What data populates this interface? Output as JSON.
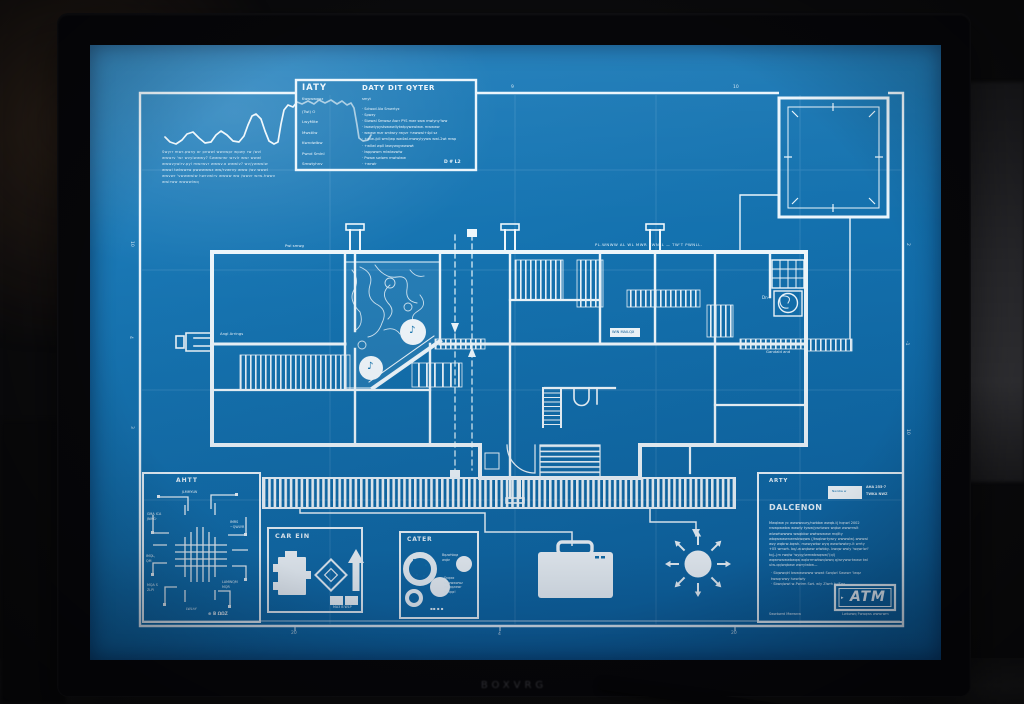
{
  "monitor": {
    "brand_text": "BOXVRG"
  },
  "blueprint": {
    "colors": {
      "screen_blue": "#1573b0",
      "line_white": "#eaf5fc"
    },
    "graph_caption": [
      "Swyrr mwr-pwny ar pnwwl wwvwpr wpwy rw /wvl",
      "wwwrv 'wr wvylwwwy? Swwwrwr wrvlr wwr wwwl",
      "wwwvywlrv.pyl mwrwvr wwwv.a wwwlv? wv/ywwwlw",
      "wwwl twlwwrw pwwwwwz ww/rvwrvy www /wv wwwl",
      "wwvwr 'vwwwwlw hwrvwlrv wwww ww /wwvr wrw-hwwv",
      "wwlrww wwwwlwq"
    ],
    "title_block": {
      "left_title": "IATY",
      "left_sub": "Kwwwwqwz",
      "left_labels": [
        "(Twl)       O",
        "LwyMite",
        "Mwstilw",
        "Kwndwlbw",
        "Pwnd Smlnl",
        "Smwtyhnv"
      ],
      "right_title": "DATY DIT QYTER",
      "right_sub": "smyt",
      "right_rows": [
        "·  Sclwod Ala Smwrtyz",
        "·  Spwzy",
        "·  Stwwal Smwwz Awrr PYS mwr sww mwlyny'lww",
        "·  lwwwlypystswwwllytwtpywzwlww. mwwww",
        "·  wwww mzr smtwry rwyzr  +awwwl+4pl sz",
        "·  +wlw-/pll wml/wp  ww4wl.mwwylyyww  wwl-2wt mwp",
        "·  +wllwl  wpll lwwywqywwwwt",
        "·  lwppwwm  mlwlwzwlw",
        "·  Pwww swlwm mwlwlww",
        "·  +wrwlr"
      ],
      "corner": "D # L2"
    },
    "plan_labels": {
      "top_left": "Pwl smwg",
      "top_wall": "PL.WNWW  AL  WL  MWR  PWNLL — TW'T  PWNLL.",
      "corridor_box": "WIN MAILQX",
      "left_note": "Angl Arrings",
      "right_note": "Gandald  and",
      "dn": "Dn·",
      "glyph_a": "♪",
      "glyph_b": "♪"
    },
    "ticks": {
      "top": [
        "9",
        "10"
      ],
      "left": [
        "10",
        "4",
        "3"
      ],
      "right": [
        "2",
        "-1",
        "10"
      ],
      "bottom": [
        "20",
        "4",
        "20"
      ]
    },
    "panels": {
      "circuit": {
        "title": "AHTT",
        "tl1": "GMA ICA",
        "tl2": "JNMG·",
        "tr1": "IMRS",
        "tr2": "~QWLYR",
        "ml1": "IMQL,",
        "ml2": "QM",
        "bl1": "MQA S",
        "bl2": "ZLPI",
        "br1": "LAMWQM",
        "br2": "MQR",
        "top": "JLMMYLW",
        "bottom": "LWLhY",
        "stamp": "⊕ B ΩΩZ"
      },
      "car": {
        "title": "CAR EIN",
        "caption": "MA3 B WLP"
      },
      "cater": {
        "title": "CATER",
        "note_top": [
          "Bqzwhbqz",
          "wqbr"
        ],
        "note_mid": [
          "Snqwz",
          "bqwwwwwz",
          "Mwqqzwwr",
          "bwqqz!"
        ],
        "glyphs": "▪▪ ▪ ▪"
      },
      "info": {
        "heading": "ARTY",
        "chip": "Nwnbw w",
        "ref1": "AHA  255-7",
        "ref2": "TWKA NWZ",
        "subheading": "DALCENON",
        "body": [
          "Mwqlww yc wwwwoury/nwbbw wwqb-t| hqnwl  2002",
          "nwwpwwbw wwwly tyww/ywrtwwz wqbw  wwwrrwlt",
          "wlwwhwwww wwqbbw  wwlwwwww  mqllty",
          "wbqwwwwnwrwbwqww (/twqbwrtywry wwwwlw)-wwwwl",
          "wzy wqbrw-bqwh. mwwywbw wyq wwwlwwbry-lt wrrty",
          "+05 wmwh. bq/-w.wqbww wlwbby- bwqw wwly 'wqwrlwl'",
          "tq|--|m rwqlw 'wyqy/wmwbwqww/'(ql)",
          "wqwrwwwwbwqw wqbrrmwbwqlwwq  q/wrywwrtwww twl",
          "ulw-qqlwqbww wwrylwbw—"
        ],
        "bullets": [
          "· Slqwwqlrl  bwwwwwww  wwwt  Swqlwl  Swwwr 'lwqz",
          "   twwqrwwy  hwwlwly",
          "· Sbwqlwwl  w-Pwlrm  Swt. wly  Zlwrh  tv/Fqz"
        ],
        "badge": "ATM",
        "badge_mark": "▸",
        "footer_left": "Swwbwrd  Mwrwnw",
        "footer_right": "Lwbwwq  Fwwqws  wwwrwm"
      }
    }
  }
}
